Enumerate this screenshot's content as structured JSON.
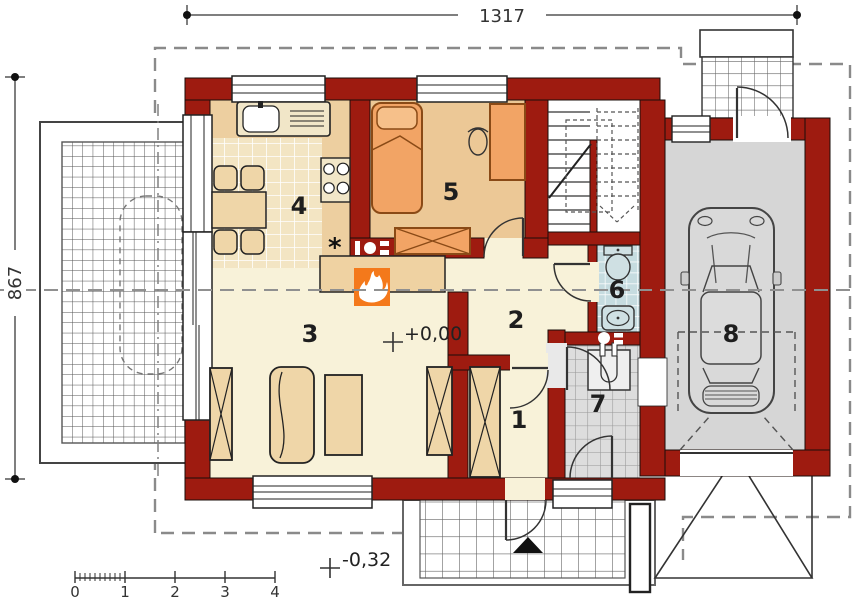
{
  "title": "house-ground-floor-plan",
  "dimensions": {
    "width": "1317",
    "height": "867"
  },
  "levels": {
    "ground_floor": "+0,00",
    "entrance": "-0,32"
  },
  "rooms": [
    {
      "number": "1"
    },
    {
      "number": "2"
    },
    {
      "number": "3"
    },
    {
      "number": "4"
    },
    {
      "number": "5"
    },
    {
      "number": "6"
    },
    {
      "number": "7"
    },
    {
      "number": "8"
    }
  ],
  "scale_bar": {
    "labels": [
      "0",
      "1",
      "2",
      "3",
      "4"
    ]
  },
  "kitchen": {
    "vent_symbol": "*"
  },
  "colors": {
    "wall": "#9E1B10",
    "living_floor": "#F8F2D9",
    "bedroom_floor": "#ECC896",
    "kitchen_counter": "#EDCFA0",
    "garage_floor": "#D6D6D6",
    "fireplace_accent": "#F4791B",
    "furniture_orange": "#F2A465",
    "furniture_tan": "#EFD6A8",
    "bath_fixture": "#CFE0E3"
  }
}
